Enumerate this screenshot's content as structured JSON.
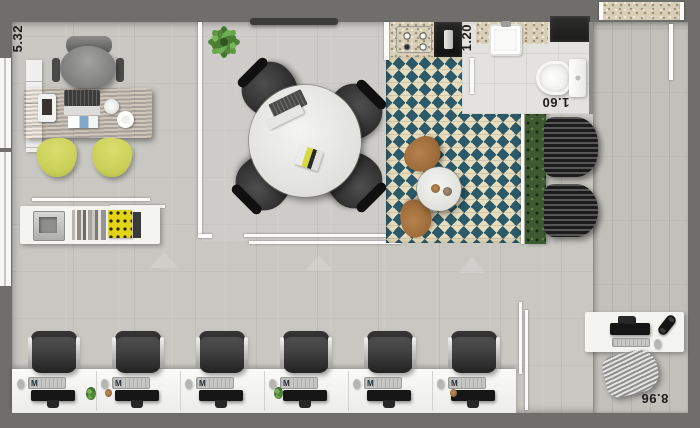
{
  "floorplan": {
    "dimensions": {
      "office_width": "5.32",
      "bathroom_width": "1.20",
      "bathroom_length": "1.60",
      "overall_depth": "8.96"
    },
    "workstations": {
      "count": 6,
      "keyboard_logo": "M"
    },
    "colors": {
      "wall": "#6f6e6b",
      "floor": "#c9c7c2",
      "hall_floor": "#c1c0bb",
      "bath_floor": "#e3e2de",
      "checker_teal": "#2b5b6b",
      "checker_cream": "#e8ddbd",
      "granite": "#d8cfb6",
      "glass": "#fbfbfa",
      "desk_wood": "#744723",
      "chair_yellow": "#c9d058",
      "plant_green": "#55853c",
      "hedge_green": "#3d5a33",
      "furniture_white": "#f4f4f1",
      "meeting_chair_black": "#2b2b2b",
      "work_chair_gray": "#454545",
      "monitor_black": "#161616",
      "lounge_gray": "#2f2f2f",
      "cafe_wood": "#9c6a38",
      "mat_beige": "#d9d1b6",
      "label_text": "#1c1c1c"
    }
  }
}
